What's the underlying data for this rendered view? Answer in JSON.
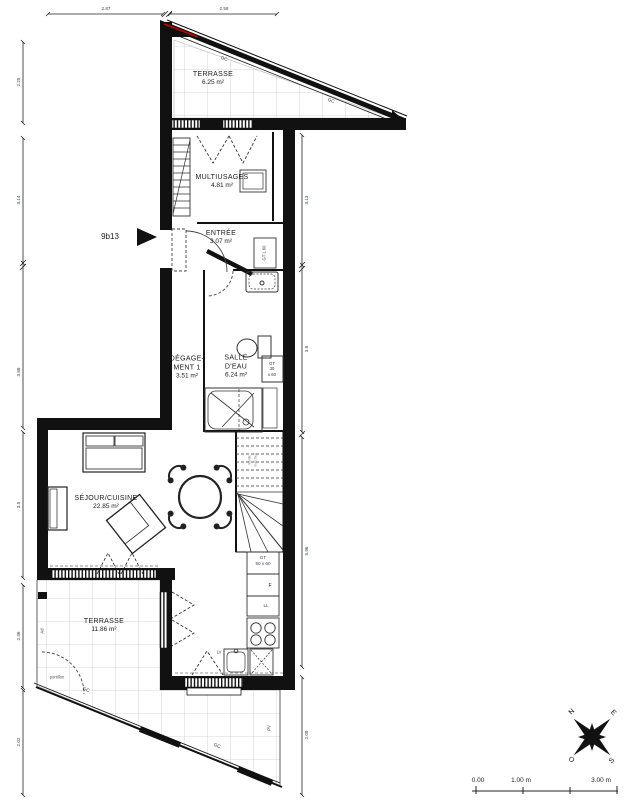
{
  "plan": {
    "unit_label": "9b13",
    "rooms": {
      "terrace_top": {
        "name": "TERRASSE",
        "area": "6.25 m²"
      },
      "multiusages": {
        "name": "MULTIUSAGES",
        "area": "4.81 m²"
      },
      "entree": {
        "name": "ENTRÉE",
        "area": "3.07 m²"
      },
      "degagement": {
        "name_line1": "DÉGAGE-",
        "name_line2": "MENT 1",
        "area": "3.51 m²"
      },
      "salle_deau": {
        "name_line1": "SALLE",
        "name_line2": "D'EAU",
        "area": "6.24 m²"
      },
      "sejour_cuisine": {
        "name": "SÉJOUR/CUISINE",
        "area": "22.85 m²"
      },
      "terrace_bottom": {
        "name": "TERRASSE",
        "area": "11.86 m²"
      }
    },
    "annotations": {
      "gc": "GC",
      "gt_closet": "GT L 60",
      "gt_30x60": [
        "GT",
        "30",
        "x 60"
      ],
      "gt_50x60": [
        "GT",
        "50 x 60"
      ],
      "fridge": "F",
      "washing_machine": "LL",
      "dishwasher": "LV",
      "ad": "Ad",
      "pv": "PV",
      "portillon": "portillon",
      "stairs": [
        "monte",
        "marches"
      ]
    },
    "dimensions": {
      "top": [
        "2.87",
        "2.58"
      ],
      "left": [
        "2.25",
        "3.14",
        "3.88",
        "3.5",
        "2.36",
        "2.02"
      ],
      "right": [
        "3.13",
        "3.8",
        "5.96",
        "2.08"
      ]
    },
    "compass": {
      "n": "N",
      "e": "E",
      "s": "S",
      "o": "O"
    },
    "scale_bar": {
      "t0": "0.00",
      "t1": "1.00 m",
      "t3": "3.00 m"
    },
    "palette": {
      "wall": "#111111",
      "accent_red": "#c40000",
      "tile_grid": "#cccccc",
      "dim_text": "#3a4656"
    }
  }
}
